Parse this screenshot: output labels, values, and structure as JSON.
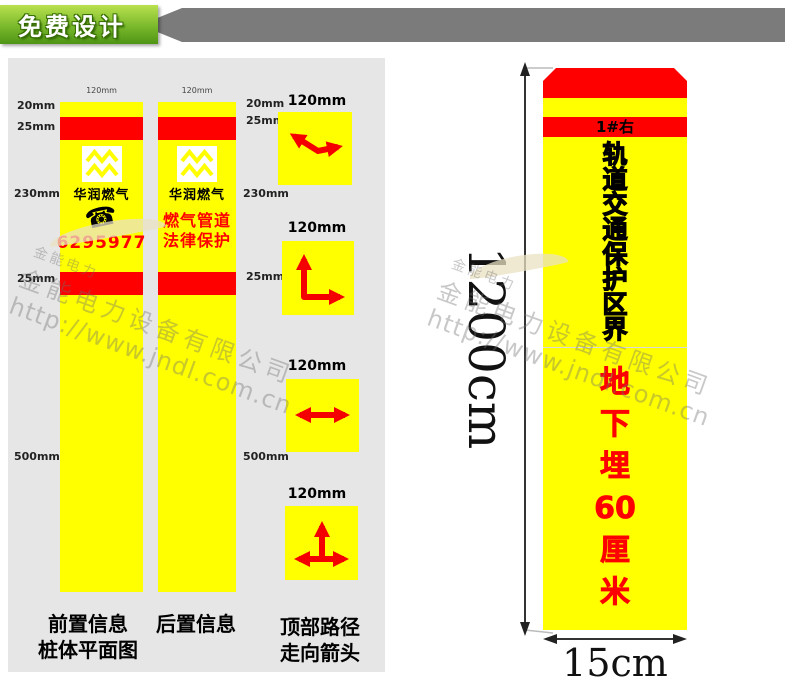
{
  "ribbon": {
    "label": "免费设计"
  },
  "colors": {
    "yellow": "#FFFF00",
    "red": "#FE0000",
    "green": "#7AB92C",
    "ribbon_gray": "#7B7B7B",
    "panel_gray": "#E6E6E6"
  },
  "panel": {
    "front_post": {
      "width_label": "120mm",
      "brand": "华润燃气",
      "phone_number": "6295977",
      "left_labels": [
        "20mm",
        "25mm",
        "230mm",
        "25mm",
        "500mm"
      ],
      "caption_line1": "前置信息",
      "caption_line2": "桩体平面图"
    },
    "back_post": {
      "width_label": "120mm",
      "brand": "华润燃气",
      "line1": "燃气管道",
      "line2": "法律保护",
      "right_labels": [
        "20mm",
        "25mm",
        "230mm",
        "25mm",
        "500mm"
      ],
      "caption": "后置信息"
    },
    "arrow_squares": {
      "labels": [
        "120mm",
        "120mm",
        "120mm",
        "120mm"
      ],
      "types": [
        "bend-left-right",
        "corner-up-right",
        "straight-both-ways",
        "tee-junction"
      ],
      "caption_line1": "顶部路径",
      "caption_line2": "走向箭头"
    }
  },
  "right_post": {
    "top_band_label": "1#右",
    "black_chars": [
      "轨",
      "道",
      "交",
      "通",
      "保",
      "护",
      "区",
      "界"
    ],
    "red_chars": [
      "地",
      "下",
      "埋",
      "60",
      "厘",
      "米"
    ],
    "height_label": "1200cm",
    "width_label": "15cm"
  },
  "icons": {
    "phone_icon": "☎"
  },
  "watermark": {
    "brand_small": "金能电力",
    "company": "金能电力设备有限公司",
    "url": "http://www.jndl.com.cn"
  }
}
